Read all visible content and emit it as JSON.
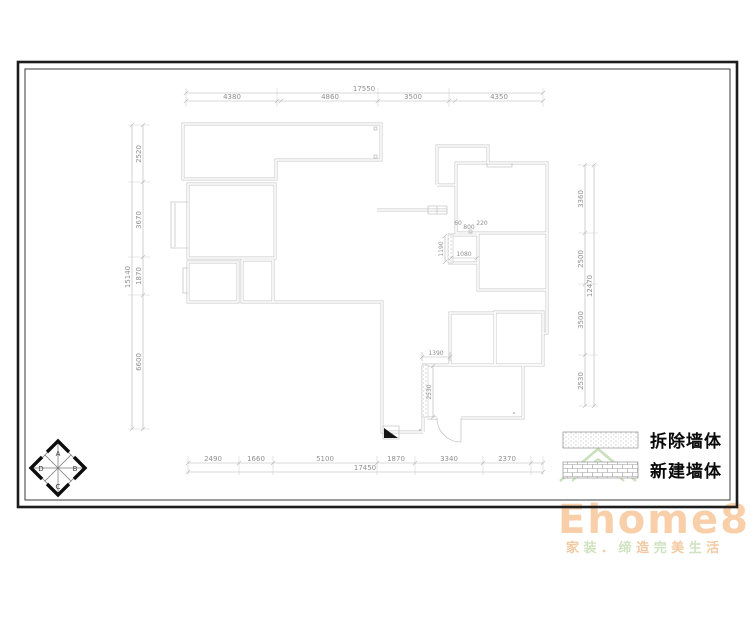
{
  "drawing": {
    "type_label": "floor-plan-demolition-drawing"
  },
  "dimensions": {
    "top": {
      "total": "17550",
      "segments": [
        "4380",
        "4860",
        "3500",
        "4350"
      ]
    },
    "bottom": {
      "total": "17450",
      "segments": [
        "2490",
        "1660",
        "5100",
        "1870",
        "3340",
        "2370"
      ]
    },
    "left": {
      "total": "15140",
      "segments": [
        "2520",
        "3670",
        "1870",
        "6600"
      ]
    },
    "right": {
      "total": "12470",
      "segments": [
        "3360",
        "2500",
        "3500",
        "2530"
      ]
    },
    "interior": {
      "d60": "60",
      "d800": "800",
      "d220": "220",
      "d1190": "1190",
      "d1080": "1080",
      "d1390": "1390",
      "d2530": "2530"
    }
  },
  "legend": {
    "demolish_label": "拆除墙体",
    "new_wall_label": "新建墙体"
  },
  "compass": {
    "north": "A",
    "east": "B",
    "south": "C",
    "west": "D"
  },
  "logo": {
    "brand": "Ehome8",
    "tagline": "家装．缔造完美生活",
    "brand_color": "#f8cfa8",
    "tagline_colors": [
      "#f3c9a2",
      "#cfe3c0"
    ]
  },
  "colors": {
    "wall": "#c9c9c9",
    "dim_line": "#b3b3b3",
    "frame": "#1c1c1c",
    "roof_green": "#cadfbc"
  }
}
